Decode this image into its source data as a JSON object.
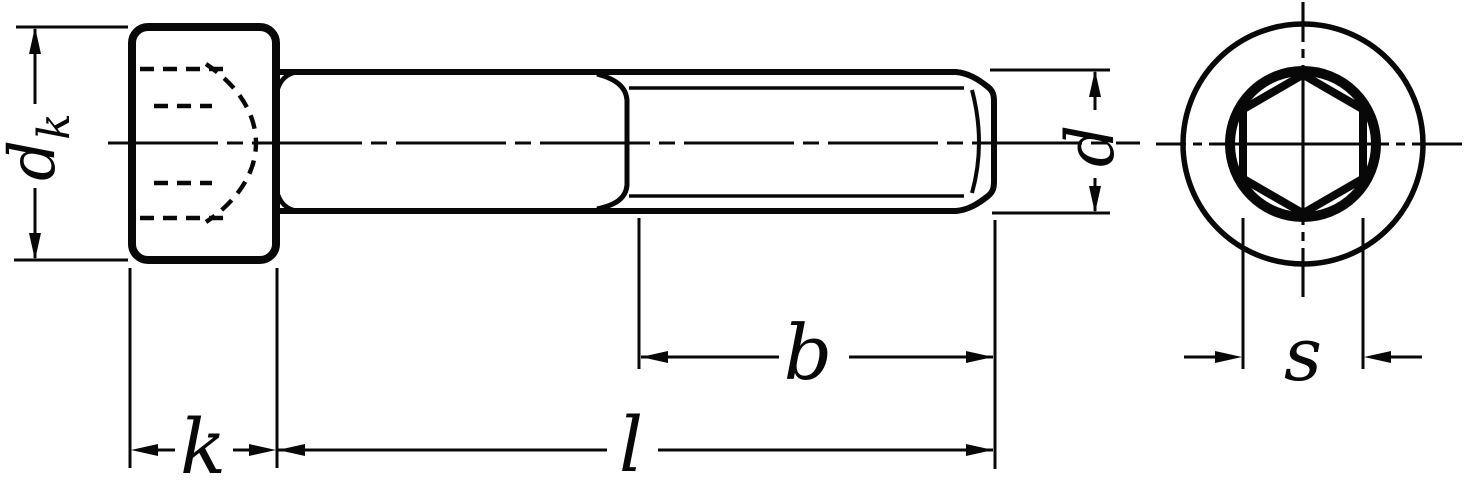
{
  "colors": {
    "background": "#ffffff",
    "ink": "#080808"
  },
  "labels": {
    "head_diameter_main": "d",
    "head_diameter_sub": "k",
    "head_height": "k",
    "overall_length": "l",
    "thread_length": "b",
    "thread_diameter": "d",
    "socket_across_flats": "s"
  }
}
